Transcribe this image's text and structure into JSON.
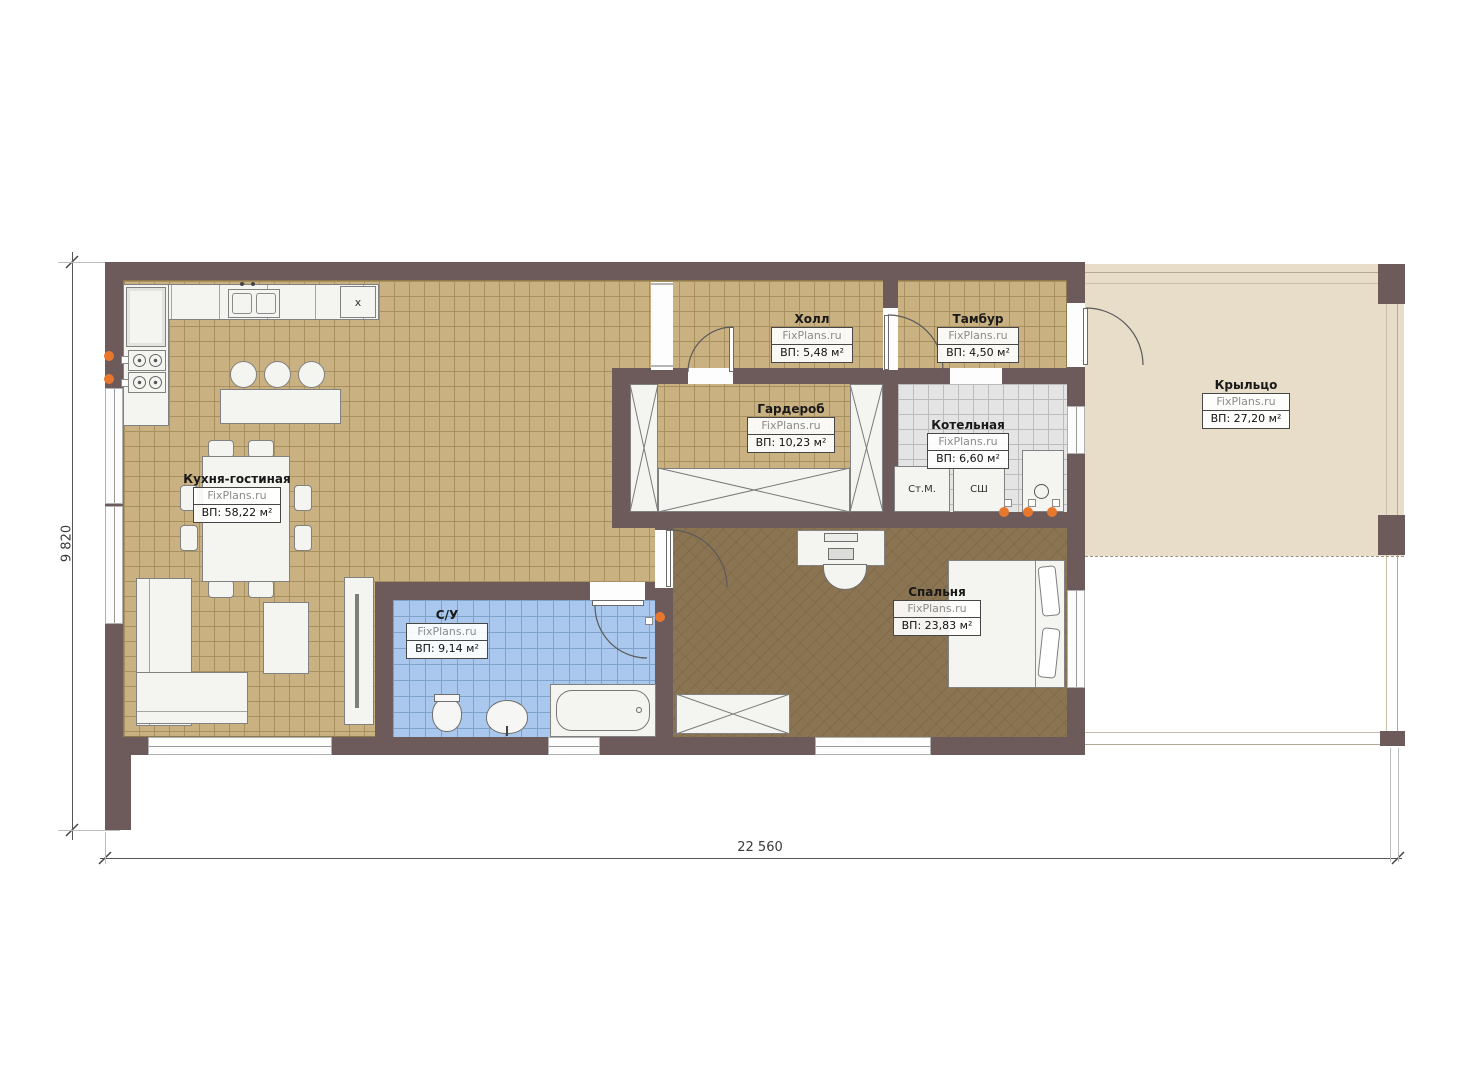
{
  "rooms": {
    "kitchen_living": {
      "name": "Кухня-гостиная",
      "brand": "FixPlans.ru",
      "area": "ВП: 58,22 м²"
    },
    "hall": {
      "name": "Холл",
      "brand": "FixPlans.ru",
      "area": "ВП: 5,48 м²"
    },
    "tambour": {
      "name": "Тамбур",
      "brand": "FixPlans.ru",
      "area": "ВП: 4,50 м²"
    },
    "wardrobe": {
      "name": "Гардероб",
      "brand": "FixPlans.ru",
      "area": "ВП: 10,23 м²"
    },
    "boiler": {
      "name": "Котельная",
      "brand": "FixPlans.ru",
      "area": "ВП: 6,60 м²"
    },
    "porch": {
      "name": "Крыльцо",
      "brand": "FixPlans.ru",
      "area": "ВП: 27,20 м²"
    },
    "bathroom": {
      "name": "С/У",
      "brand": "FixPlans.ru",
      "area": "ВП: 9,14 м²"
    },
    "bedroom": {
      "name": "Спальня",
      "brand": "FixPlans.ru",
      "area": "ВП: 23,83 м²"
    }
  },
  "dimensions": {
    "overall_width": "22 560",
    "overall_height": "9 820"
  },
  "equipment_labels": {
    "washing_machine": "Ст.М.",
    "drying_cabinet": "СШ",
    "hob_mark": "x"
  },
  "colors": {
    "wall": "#6d5b5b",
    "kitchen_tile": "#c9b182",
    "bedroom_wood": "#8a7452",
    "bath_tile": "#aac8ee",
    "boiler_tile": "#e4e4e4",
    "porch_floor": "#e7ddc9",
    "heater_orange": "#e8772e"
  }
}
